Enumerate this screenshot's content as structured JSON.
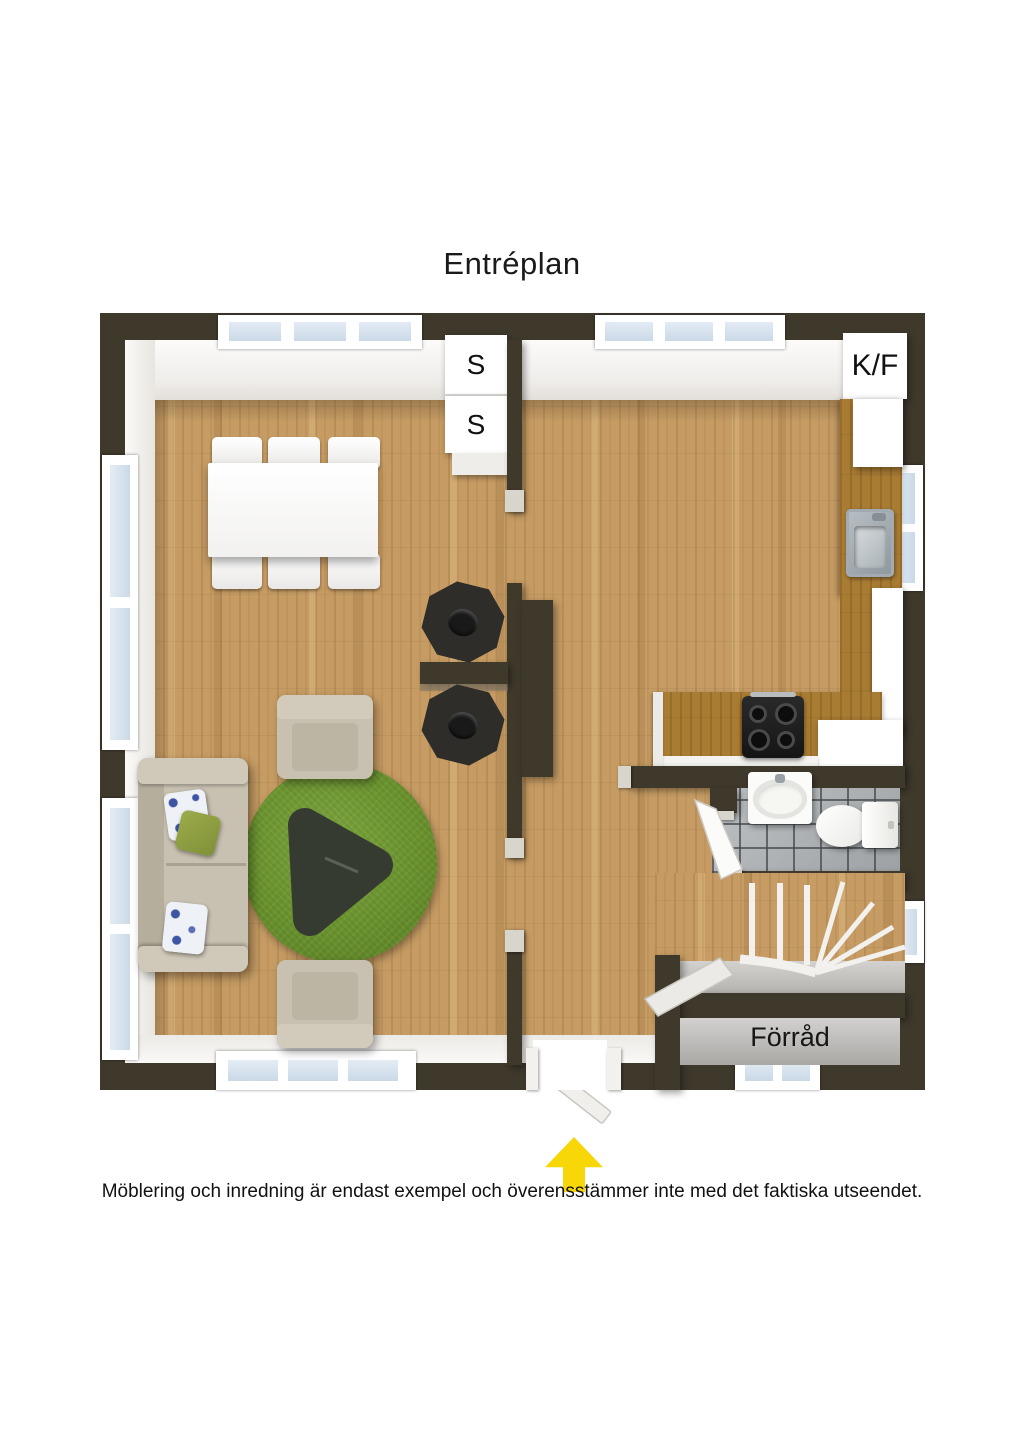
{
  "page": {
    "title": "Entréplan",
    "disclaimer": "Möblering och inredning är endast exempel och överensstämmer inte med det faktiska utseendet."
  },
  "floor_plan": {
    "labels": {
      "wardrobe_top": "S",
      "wardrobe_bottom": "S",
      "fridge_freezer": "K/F",
      "storage": "Förråd"
    },
    "icons": {
      "entrance_arrow": "arrow-up-yellow"
    },
    "colors": {
      "wall_dark": "#3F392C",
      "floor_wood": "#C69C64",
      "counter_wood": "#A97C33",
      "rug_green": "#6B9231",
      "bathroom_tile_gray": "#A7ABAD",
      "storage_floor_gray": "#BDBCBA",
      "furniture_beige": "#C8C1B1",
      "entrance_arrow_yellow": "#F7D708",
      "window_glass_blue": "#D3E0EC"
    }
  }
}
